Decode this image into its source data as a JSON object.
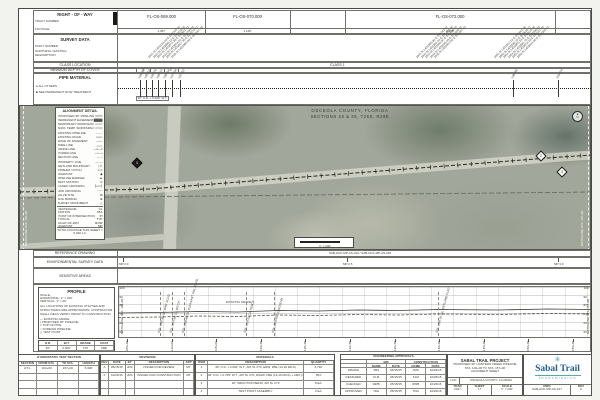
{
  "header_rows": {
    "right_of_way": {
      "label": "RIGHT - OF - WAY",
      "sub_top": "TRACT NUMBER",
      "sub_bottom": "FOOTAGE"
    },
    "survey": {
      "label": "SURVEY DATA",
      "subs": [
        "POINT NUMBER",
        "NORTHING / EASTING",
        "DESCRIPTION"
      ]
    },
    "class_location": {
      "label": "CLASS LOCATION",
      "value": "CLASS 1"
    },
    "depth_of_cover": {
      "label": "MINIMUM DEPTH OF COVER",
      "values": [
        "3'",
        "3'"
      ]
    },
    "pipe_material": {
      "label": "PIPE MATERIAL",
      "legend": [
        {
          "symbol": "●",
          "text": "ALL OTHERS"
        },
        {
          "symbol": "■",
          "text": "SEE PERMANENT ROW TREATMENT"
        }
      ],
      "pipe_label": "36\" O.D. x 0.600\" W.T.",
      "tick_labels": [
        "104+86",
        "105+32",
        "105+78",
        "106+15",
        "106+64",
        "107+08",
        "107+52",
        "148+89",
        "153+24"
      ]
    }
  },
  "tracts": [
    {
      "id": "FL-OS-069.000",
      "footage": "1,367'"
    },
    {
      "id": "FL-OS-070.000",
      "footage": "1,160'"
    },
    {
      "id": "FL-OS-072.000",
      "footage": "4,158'"
    }
  ],
  "survey_clusters": [
    [
      "1021  N 1403126.44  E 528244.18",
      "1022  N 1403098.12  E 528419.55",
      "1023  N 1403071.88  E 528601.23",
      "1024  N 1403044.61  E 528790.02",
      "1025  N 1403017.35  E 528978.81",
      "1026  N 1402990.08  E 529167.60"
    ],
    [
      "1041  N 1403355.92  E 531242.07",
      "1042  N 1403382.44  E 531430.86",
      "1043  N 1403408.97  E 531619.65",
      "1044  N 1403435.49  E 531808.44",
      "1045  N 1403462.02  E 531997.23"
    ],
    [
      "1051  N 1403512.18  E 532441.88",
      "1052  N 1403538.70  E 532630.67",
      "1053  N 1403565.23  E 532819.46",
      "1054  N 1403591.75  E 533008.25",
      "1055  N 1403618.28  E 533197.04",
      "1056  N 1403644.80  E 533385.83"
    ]
  ],
  "map": {
    "county_line1": "OSCEOLA COUNTY, FLORIDA",
    "county_line2": "SECTIONS 26 & 35, T25S, R29E",
    "scale_text": "1\" = 200'",
    "north_label": "N",
    "markers": [
      "1",
      "2",
      "3"
    ],
    "matchline_left": "MATCHLINE STA. 104+00",
    "matchline_right": "MATCHLINE STA. 157+00"
  },
  "alignment_detail": {
    "title": "ALIGNMENT DETAIL",
    "rows": [
      [
        "PROPOSED 36\" PIPELINE",
        "━━━━"
      ],
      [
        "PERMANENT EASEMENT",
        "▓▓▓▓"
      ],
      [
        "TEMPORARY WORKSPACE",
        "┅┅┅┅"
      ],
      [
        "ADD'L TEMP. WORKSPACE",
        "╍╍╍╍"
      ],
      [
        "EXISTING PIPELINE",
        "– – –"
      ],
      [
        "EXISTING ROAD",
        "═══"
      ],
      [
        "EDGE OF PAVEMENT",
        "───"
      ],
      [
        "TREE LINE",
        "︵︵"
      ],
      [
        "FENCE LINE",
        "—x—x"
      ],
      [
        "POWER LINE",
        "—•—•"
      ],
      [
        "SECTION LINE",
        "─ ─"
      ],
      [
        "PROPERTY LINE",
        "—·—"
      ],
      [
        "WETLAND BOUNDARY",
        "⌇⌇⌇"
      ],
      [
        "STREAM / DITCH",
        "≈≈≈"
      ],
      [
        "MILEPOST",
        "◆"
      ],
      [
        "PIPELINE MARKER",
        "▲"
      ],
      [
        "TEST STATION",
        "⊙"
      ],
      [
        "CASED CROSSING",
        "╞══╡"
      ],
      [
        "HDD CROSSING",
        "◠◠"
      ],
      [
        "VALVE SITE",
        "⊠"
      ],
      [
        "SOIL BORING",
        "⊕"
      ],
      [
        "SURVEY MONUMENT",
        "△"
      ]
    ],
    "footer": [
      [
        "CENTERLINE",
        "CL"
      ],
      [
        "STATION",
        "STA"
      ],
      [
        "POINT OF INTERSECTION",
        "PI"
      ],
      [
        "TYPICAL",
        "TYP"
      ],
      [
        "RIGHT-OF-WAY",
        "ROW"
      ],
      [
        "MILEPOST",
        "MP"
      ]
    ],
    "total": "TOTAL FOOTAGE THIS SHEET = 5,300 L.F."
  },
  "lower_rows": {
    "reference": {
      "label": "REFERENCE DRAWING",
      "value": "SAB-HCK-MP-AS-016  /  SAB-HCK-MP-AS-018"
    },
    "environmental": {
      "label": "ENVIRONMENTAL SURVEY DATA",
      "mileposts": [
        "MP 2.0",
        "MP 2.5",
        "MP 3.0"
      ]
    },
    "sensitive": {
      "label": "SENSITIVE AREAS"
    }
  },
  "profile": {
    "title": "PROFILE",
    "scale_heading": "SCALE:",
    "scale_h": "HORIZONTAL: 1\" = 200'",
    "scale_v": "VERTICAL: 1\" = 20'",
    "note": "ALL LOCATIONS OF EXISTING UTILITIES AND STRUCTURES ARE APPROXIMATE. CONTRACTOR SHALL FIELD VERIFY PRIOR TO CONSTRUCTION.",
    "legend": [
      {
        "symbol": "—",
        "text": "EXISTING GRADE"
      },
      {
        "symbol": "▪",
        "text": "PROPOSED 36\" PIPELINE"
      },
      {
        "symbol": "□",
        "text": "TOP OF PIPE"
      },
      {
        "symbol": "○",
        "text": "FOREIGN PIPELINE"
      },
      {
        "symbol": "△",
        "text": "TEST POINT"
      }
    ],
    "grade_label": "EXISTING GRADE",
    "elevations": [
      "100",
      "90",
      "80",
      "70",
      "60",
      "50"
    ],
    "stations": [
      "105+00",
      "110+00",
      "115+00",
      "120+00",
      "125+00",
      "130+00",
      "135+00",
      "140+00",
      "145+00",
      "150+00",
      "155+00"
    ],
    "annotations": [
      "STA. 106+90 C/L DIRT ROAD",
      "STA. 107+85 C/L DITCH",
      "STA. 109+40 C/L PLEASANT HILL ROAD",
      "STA. 118+20 C/L FENCE",
      "STA. 121+45 C/L STREAM",
      "STA. 139+70 C/L WETLAND FLAG"
    ],
    "matchline_left": "MATCHLINE STA. 104+00",
    "matchline_right": "MATCHLINE STA. 157+00",
    "design_table": {
      "headers": [
        "O.D.",
        "W.T.",
        "GRADE",
        "COAT"
      ],
      "row": [
        "36\"",
        "0.600\"",
        "X70",
        "FBE"
      ]
    }
  },
  "hydro": {
    "title": "HYDROSTATIC TEST SECTION",
    "headers": [
      "SECTION",
      "FROM STA.",
      "TO STA.",
      "LENGTH"
    ],
    "rows": [
      [
        "HT-1",
        "104+00",
        "157+00",
        "5,300'"
      ]
    ]
  },
  "revisions": {
    "title": "REVISIONS",
    "headers": [
      "REV",
      "DATE",
      "BY",
      "DESCRIPTION",
      "APP"
    ],
    "rows": [
      [
        "A",
        "05/15/15",
        "JDS",
        "ISSUED FOR REVIEW",
        "MT"
      ],
      [
        "0",
        "10/26/15",
        "JDS",
        "ISSUED FOR CONSTRUCTION",
        "MT"
      ]
    ]
  },
  "materials": {
    "title": "MATERIALS",
    "headers": [
      "ITEM",
      "DESCRIPTION",
      "QUANTITY"
    ],
    "rows": [
      [
        "1",
        "36\" O.D. x 0.600\" W.T., API 5L X70, ERW, FBE (14-16 MILS)",
        "4,746'"
      ],
      [
        "2",
        "36\" O.D. x 0.709\" W.T., API 5L X70, DSAW, FBE (14-16 MILS) + ARO (40 MILS)",
        "554'"
      ],
      [
        "3",
        "36\" INDUCTION BEND, API 5L X70",
        "8 EA."
      ],
      [
        "4",
        "TEST POINT ASSEMBLY",
        "2 EA."
      ]
    ]
  },
  "approvals": {
    "title": "ENGINEERING APPROVALS",
    "group_bid": "BID",
    "group_construction": "CONSTRUCTION",
    "sub_name": "NAME",
    "sub_date": "DATE",
    "rows": [
      {
        "role": "DRAWN",
        "bid_name": "JMS",
        "bid_date": "05/15/15",
        "con_name": "JMS",
        "con_date": "10/26/15"
      },
      {
        "role": "DESIGNED",
        "bid_name": "KLM",
        "bid_date": "05/15/15",
        "con_name": "KLM",
        "con_date": "10/26/15"
      },
      {
        "role": "CHECKED",
        "bid_name": "RWB",
        "bid_date": "05/15/15",
        "con_name": "RWB",
        "con_date": "10/26/15"
      },
      {
        "role": "APPROVED",
        "bid_name": "TDH",
        "bid_date": "05/15/15",
        "con_name": "TDH",
        "con_date": "10/26/15"
      }
    ]
  },
  "title_block": {
    "project": "SABAL TRAIL PROJECT",
    "line2": "PROPOSED 36\" HUNTERS CREEK PIPELINE",
    "line3": "STA. 104+00 TO STA. 157+00",
    "line4": "ALIGNMENT SHEET",
    "loc_label": "LOC",
    "loc_value": "OSCEOLA COUNTY, FLORIDA",
    "year_label": "YEAR",
    "year": "2017",
    "sheet_label": "SHEET",
    "sheet": "17",
    "scale_label": "SCALE",
    "scale": "1\" = 200'",
    "dwg_label": "DWG",
    "dwg": "SAB-HCK-MP-AS-017",
    "rev_label": "REV",
    "rev": "0"
  },
  "logo": {
    "name": "Sabal Trail",
    "subtitle": "TRANSMISSION",
    "blue": "#1f6096",
    "teal": "#56a7b0",
    "mark": "✳"
  }
}
